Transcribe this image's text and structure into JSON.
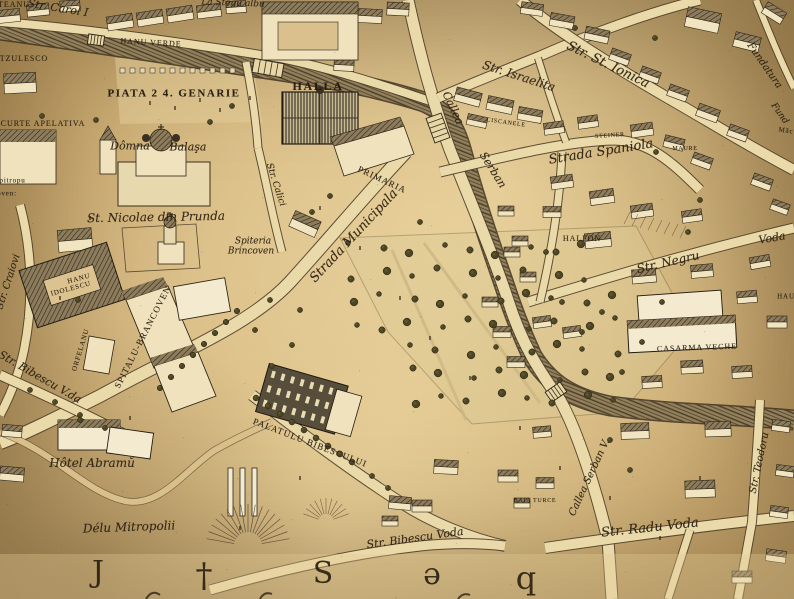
{
  "map": {
    "palette": {
      "parchment": "#d7ba83",
      "parchment_light": "#e4cd9b",
      "parchment_dark": "#c2a166",
      "ink": "#2e2519",
      "street_fill": "#ead9a9",
      "street_edge": "#50402a",
      "river_dark": "#3f3322",
      "river_mid": "#93815d",
      "roof": "#8d7c5c",
      "building_face": "#f1e5c1",
      "tree": "#4b4524",
      "label_ink": "#2b2012"
    },
    "labels": [
      {
        "text": "TEANU",
        "x": 14,
        "y": 5,
        "rot": 0,
        "cls": "caps",
        "size": 8
      },
      {
        "text": "Str. Carol I",
        "x": 58,
        "y": 8,
        "rot": 9,
        "cls": "script",
        "size": 11
      },
      {
        "text": "La Stegu albu",
        "x": 233,
        "y": 4,
        "rot": 2,
        "cls": "script",
        "size": 9
      },
      {
        "text": "HANU VERDE",
        "x": 151,
        "y": 43,
        "rot": 3,
        "cls": "caps",
        "size": 8
      },
      {
        "text": "TZULESCO",
        "x": 24,
        "y": 59,
        "rot": 0,
        "cls": "caps",
        "size": 8
      },
      {
        "text": "PIATA 2 4. GENARIE",
        "x": 174,
        "y": 94,
        "rot": 0,
        "cls": "caps-bold",
        "size": 11
      },
      {
        "text": "CURTE APELATIVA",
        "x": 43,
        "y": 124,
        "rot": 0,
        "cls": "caps",
        "size": 8
      },
      {
        "text": "HALLA",
        "x": 318,
        "y": 86,
        "rot": 0,
        "cls": "caps-bold",
        "size": 12
      },
      {
        "text": "Str. Israelita",
        "x": 519,
        "y": 76,
        "rot": 18,
        "cls": "script",
        "size": 12
      },
      {
        "text": "Str. St. Ionica",
        "x": 608,
        "y": 65,
        "rot": 26,
        "cls": "script",
        "size": 13
      },
      {
        "text": "Fundatura",
        "x": 764,
        "y": 66,
        "rot": 55,
        "cls": "script",
        "size": 10
      },
      {
        "text": "Fund",
        "x": 779,
        "y": 114,
        "rot": 55,
        "cls": "script",
        "size": 9
      },
      {
        "text": "Măc",
        "x": 786,
        "y": 131,
        "rot": 8,
        "cls": "caps",
        "size": 7
      },
      {
        "text": "CISCANELE",
        "x": 506,
        "y": 123,
        "rot": 8,
        "cls": "caps",
        "size": 6
      },
      {
        "text": "STEINER",
        "x": 610,
        "y": 136,
        "rot": -4,
        "cls": "caps",
        "size": 6
      },
      {
        "text": "MAURE",
        "x": 685,
        "y": 149,
        "rot": 0,
        "cls": "caps",
        "size": 6
      },
      {
        "text": "Strada Spaniola",
        "x": 601,
        "y": 152,
        "rot": -9,
        "cls": "script",
        "size": 13
      },
      {
        "text": "Callea",
        "x": 453,
        "y": 108,
        "rot": 65,
        "cls": "script",
        "size": 11
      },
      {
        "text": "Serban",
        "x": 493,
        "y": 170,
        "rot": 58,
        "cls": "script",
        "size": 11
      },
      {
        "text": "Dômna",
        "x": 130,
        "y": 146,
        "rot": 0,
        "cls": "script",
        "size": 11
      },
      {
        "text": "Balaşa",
        "x": 188,
        "y": 147,
        "rot": 0,
        "cls": "script",
        "size": 11
      },
      {
        "text": "Epitropu",
        "x": 10,
        "y": 181,
        "rot": 0,
        "cls": "caps",
        "size": 7
      },
      {
        "text": "oven:",
        "x": 7,
        "y": 194,
        "rot": 0,
        "cls": "caps",
        "size": 7
      },
      {
        "text": "St. Nicolae din Prunda",
        "x": 156,
        "y": 217,
        "rot": -1,
        "cls": "script",
        "size": 12
      },
      {
        "text": "Spiteria",
        "x": 253,
        "y": 242,
        "rot": 0,
        "cls": "script",
        "size": 9
      },
      {
        "text": "Brincoven",
        "x": 251,
        "y": 252,
        "rot": 0,
        "cls": "script",
        "size": 9
      },
      {
        "text": "PRIMARIA",
        "x": 382,
        "y": 180,
        "rot": 25,
        "cls": "caps",
        "size": 9
      },
      {
        "text": "Strada Municipala",
        "x": 354,
        "y": 236,
        "rot": -47,
        "cls": "script",
        "size": 13
      },
      {
        "text": "Str. Calici",
        "x": 275,
        "y": 185,
        "rot": 72,
        "cls": "script",
        "size": 9
      },
      {
        "text": "HALFON",
        "x": 582,
        "y": 239,
        "rot": 0,
        "cls": "caps",
        "size": 8
      },
      {
        "text": "Str. Negru",
        "x": 668,
        "y": 262,
        "rot": -13,
        "cls": "script",
        "size": 12
      },
      {
        "text": "Voda",
        "x": 772,
        "y": 238,
        "rot": -10,
        "cls": "script",
        "size": 11
      },
      {
        "text": "HAU",
        "x": 786,
        "y": 297,
        "rot": 0,
        "cls": "caps",
        "size": 7
      },
      {
        "text": "CASARMA VECHE",
        "x": 697,
        "y": 348,
        "rot": -2,
        "cls": "caps",
        "size": 8
      },
      {
        "text": "HANU",
        "x": 79,
        "y": 279,
        "rot": -15,
        "cls": "caps",
        "size": 7
      },
      {
        "text": "IDOLESCU",
        "x": 71,
        "y": 289,
        "rot": -15,
        "cls": "caps",
        "size": 7
      },
      {
        "text": "ORFELANU",
        "x": 81,
        "y": 350,
        "rot": -73,
        "cls": "caps",
        "size": 7
      },
      {
        "text": "SPITALU-BRANCOVEN",
        "x": 143,
        "y": 337,
        "rot": -63,
        "cls": "caps",
        "size": 9
      },
      {
        "text": "Str. Craiovi",
        "x": 9,
        "y": 282,
        "rot": -72,
        "cls": "script",
        "size": 10
      },
      {
        "text": "Str. Bibescu V.da",
        "x": 40,
        "y": 377,
        "rot": 30,
        "cls": "script",
        "size": 11
      },
      {
        "text": "Hôtel Abramŭ",
        "x": 92,
        "y": 463,
        "rot": 0,
        "cls": "script",
        "size": 12
      },
      {
        "text": "Délu Mitropolii",
        "x": 129,
        "y": 527,
        "rot": -2,
        "cls": "script",
        "size": 12
      },
      {
        "text": "PALATULU BIBESCULUI",
        "x": 310,
        "y": 443,
        "rot": 21,
        "cls": "caps",
        "size": 9
      },
      {
        "text": "BAIA TURCE",
        "x": 535,
        "y": 501,
        "rot": 0,
        "cls": "caps",
        "size": 6
      },
      {
        "text": "Callea Serban V.",
        "x": 590,
        "y": 478,
        "rot": -65,
        "cls": "script",
        "size": 10
      },
      {
        "text": "Str. Radu Voda",
        "x": 650,
        "y": 528,
        "rot": -6,
        "cls": "script",
        "size": 13
      },
      {
        "text": "Str. Bibescu Voda",
        "x": 415,
        "y": 538,
        "rot": -8,
        "cls": "script",
        "size": 11
      },
      {
        "text": "Str. Teodoru",
        "x": 760,
        "y": 463,
        "rot": -78,
        "cls": "script",
        "size": 10
      }
    ],
    "margin_letters": [
      {
        "glyph": "J",
        "x": 98,
        "y": 573,
        "size": 30
      },
      {
        "glyph": "†",
        "x": 204,
        "y": 576,
        "size": 34
      },
      {
        "glyph": "S",
        "x": 323,
        "y": 574,
        "size": 30
      },
      {
        "glyph": "ǝ",
        "x": 432,
        "y": 575,
        "size": 30
      },
      {
        "glyph": "q",
        "x": 526,
        "y": 578,
        "size": 32
      }
    ]
  }
}
